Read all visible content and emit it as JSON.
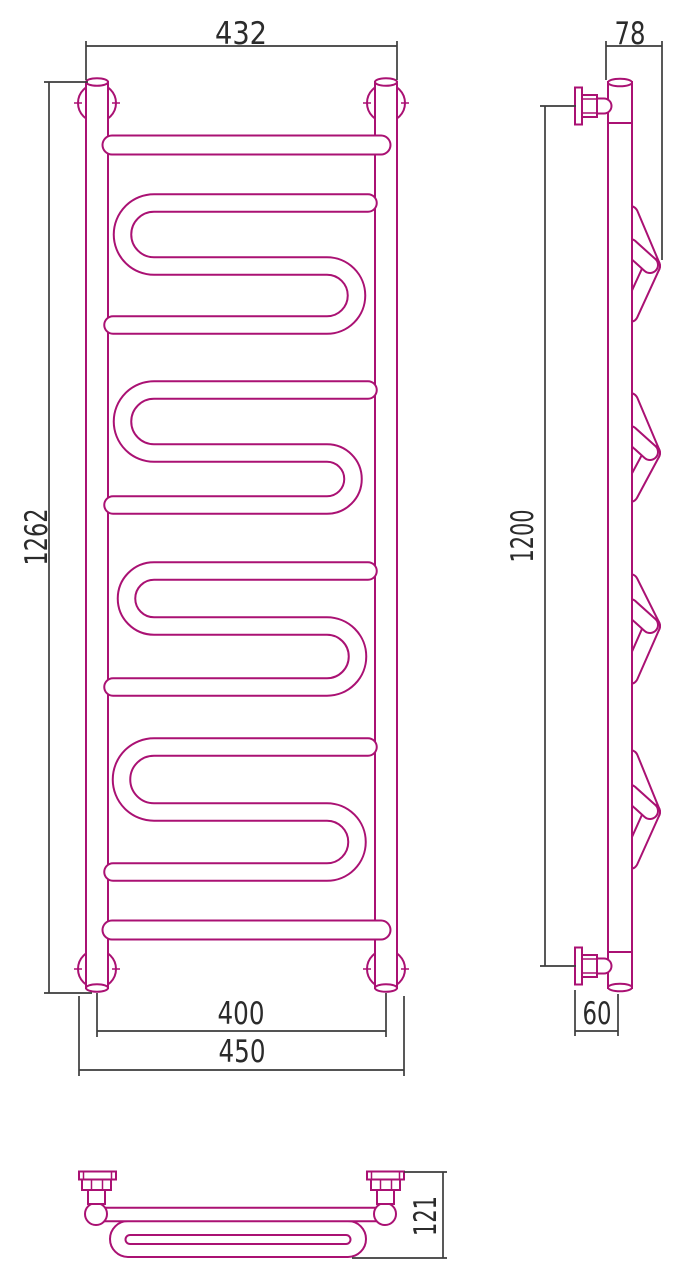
{
  "drawing": {
    "colors": {
      "outline": "#AA1173",
      "dimension_lines": "#3C3C3C",
      "dimension_text": "#2B2B2B",
      "background": "#FFFFFF"
    },
    "front_view": {
      "dim_width_top": "432",
      "dim_height_overall": "1262",
      "dim_mount_spacing": "400",
      "dim_width_overall": "450"
    },
    "side_view": {
      "dim_depth_top": "78",
      "dim_mount_height": "1200",
      "dim_wall_offset_bottom": "60"
    },
    "top_view": {
      "dim_depth_overall": "121"
    }
  }
}
